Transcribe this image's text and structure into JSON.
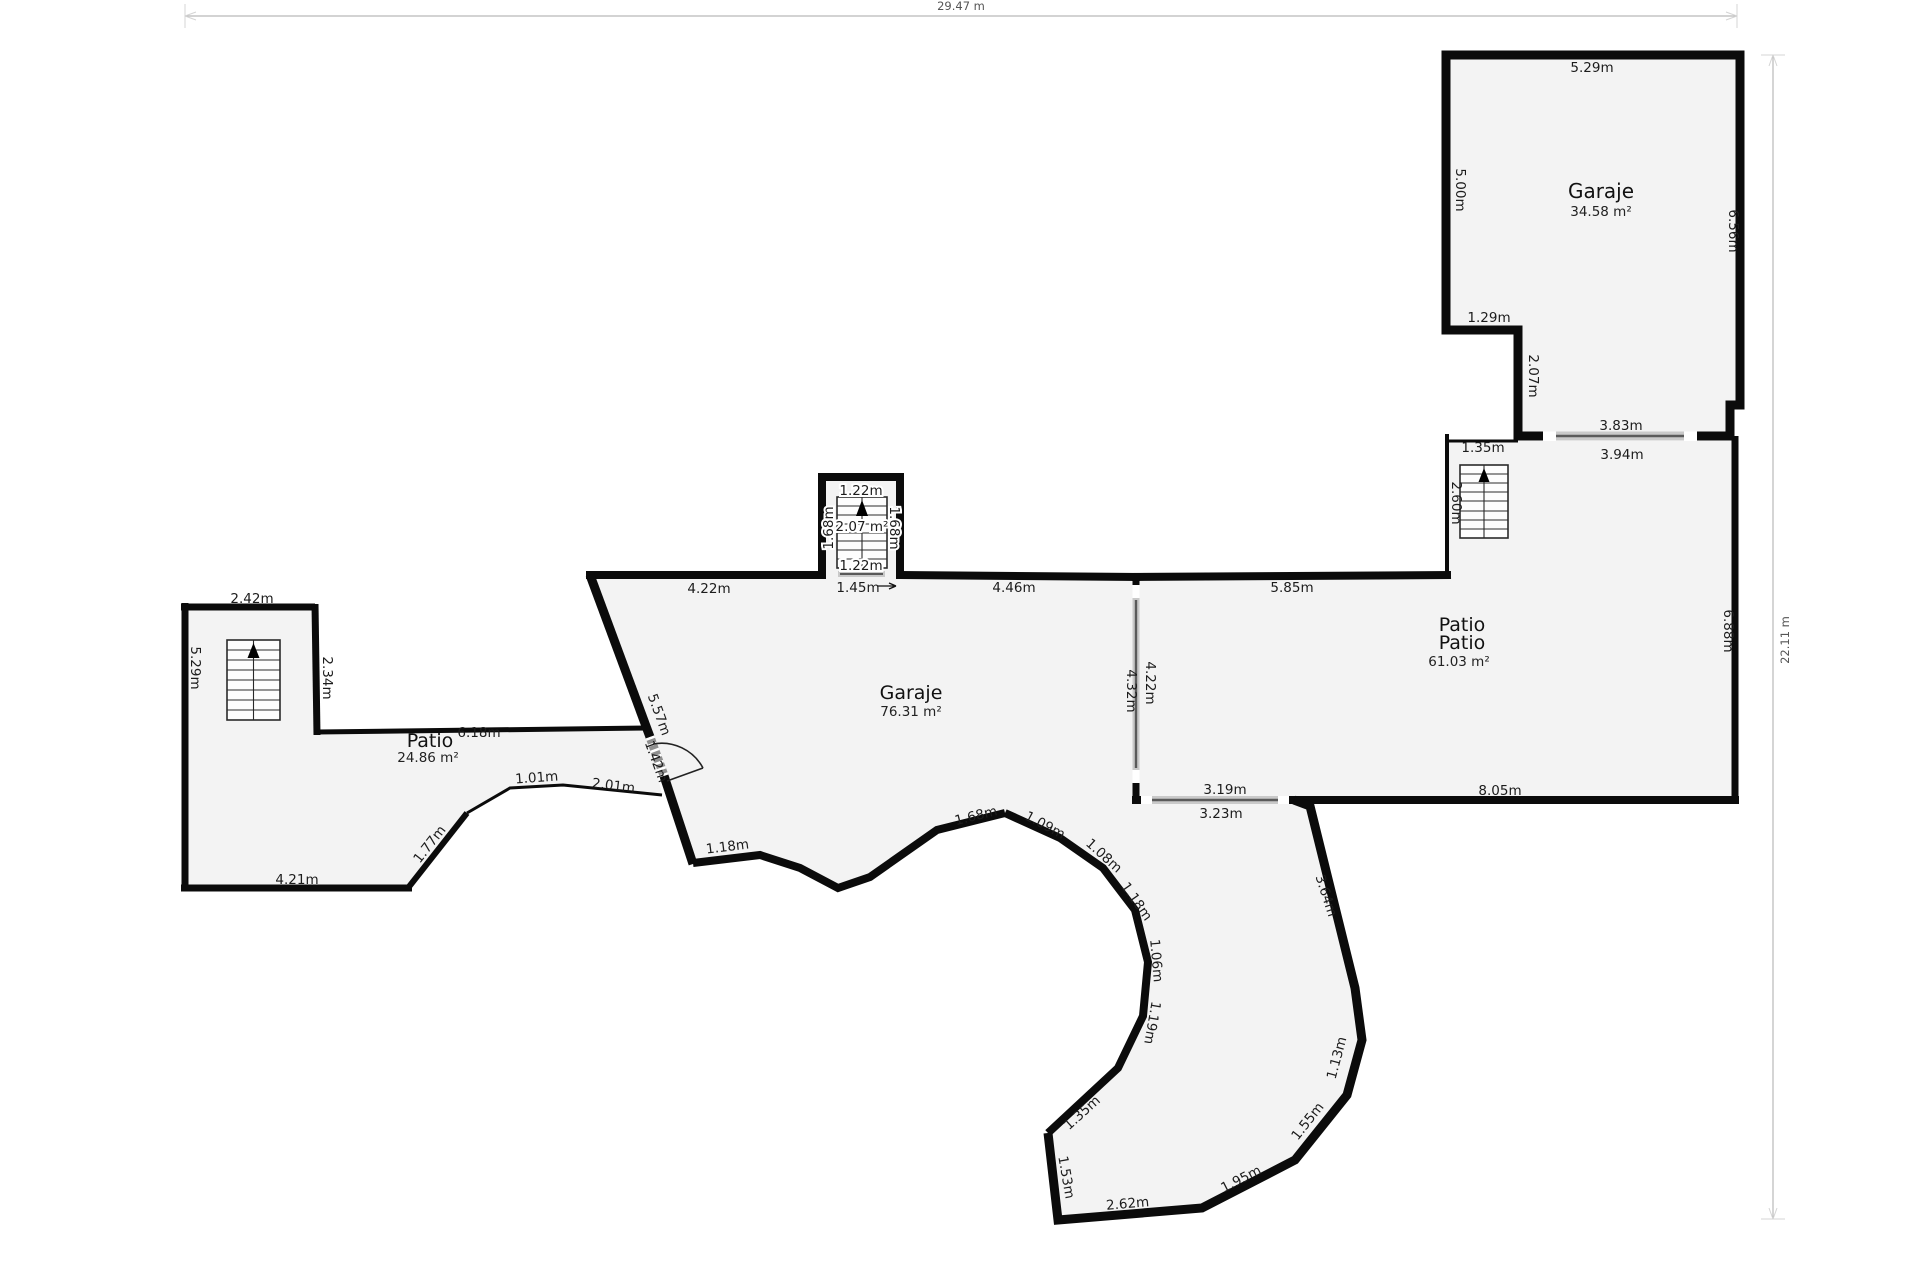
{
  "title": "Floor plan",
  "colors": {
    "wall": "#0b0b0b",
    "floor": "#f3f3f3",
    "window_base": "#c9c9c9",
    "window_core": "#5a5a5a",
    "ruler": "#b9b9b9",
    "text": "#1c1c1c"
  },
  "rulers": {
    "width": "29.47 m",
    "height": "22.11 m"
  },
  "rooms": {
    "garage_top_right": {
      "name": "Garaje",
      "area": "34.58 m²"
    },
    "patio_right": {
      "name_line1": "Patio",
      "name_line2": "Patio",
      "area": "61.03 m²"
    },
    "garage_center": {
      "name": "Garaje",
      "area": "76.31 m²"
    },
    "patio_left": {
      "name": "Patio",
      "area": "24.86 m²"
    },
    "stairwell_center": {
      "area": "2.07 m²"
    }
  },
  "dims": {
    "g1_top": "5.29m",
    "g1_left": "5.00m",
    "g1_right": "6.56m",
    "g1_notch_w": "1.29m",
    "g1_notch_h": "2.07m",
    "g1_window": "3.83m",
    "p2_window_top": "3.94m",
    "p2_offset": "1.35m",
    "p2_stairs": "2.60m",
    "p2_top": "5.85m",
    "p2_right": "6.88m",
    "p2_bottom": "8.05m",
    "p2_window_bottom_out": "3.19m",
    "p2_window_bottom_in": "3.23m",
    "p2_divider_left": "4.32m",
    "p2_divider_right": "4.22m",
    "g2_top_left": "4.22m",
    "g2_top_right": "4.46m",
    "g2_stair_top": "1.22m",
    "g2_stair_bottom": "1.22m",
    "g2_stair_width": "1.45m",
    "g2_stair_left": "1.68m",
    "g2_stair_right": "1.68m",
    "g2_diagonal": "5.57m",
    "g2_door": "1.42m",
    "g2_bottom1": "1.18m",
    "g2_bottom2": "1.68m",
    "arc_109": "1.09m",
    "arc_108": "1.08m",
    "arc_118": "1.18m",
    "arc_106": "1.06m",
    "arc_119": "1.19m",
    "arc_135": "1.35m",
    "out_153": "1.53m",
    "out_262": "2.62m",
    "out_195": "1.95m",
    "out_155": "1.55m",
    "out_113": "1.13m",
    "out_364": "3.64m",
    "p1_top": "2.42m",
    "p1_right": "2.34m",
    "p1_left": "5.29m",
    "p1_bottom": "4.21m",
    "p1_diag": "1.77m",
    "p1_corridor": "6.18m",
    "p1_edge1": "1.01m",
    "p1_edge2": "2.01m"
  }
}
